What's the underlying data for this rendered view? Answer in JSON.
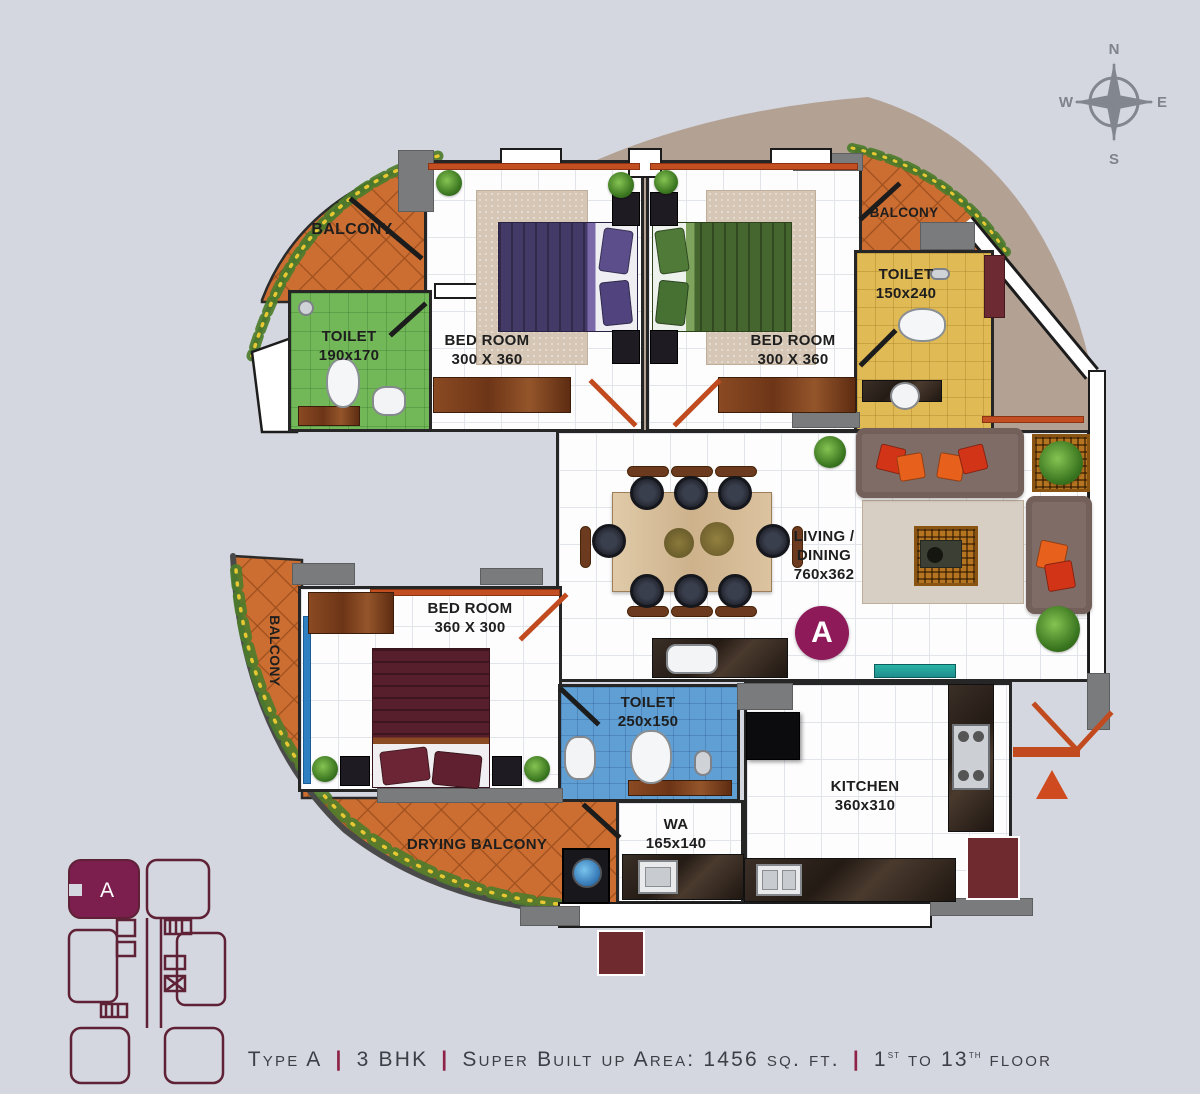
{
  "compass": {
    "north": "N",
    "south": "S",
    "east": "E",
    "west": "W"
  },
  "unit_badge": {
    "label": "A"
  },
  "key_plan": {
    "highlight_label": "A"
  },
  "rooms": {
    "balcony_top_left": {
      "label": "BALCONY"
    },
    "toilet_top_left": {
      "label": "TOILET",
      "size": "190x170"
    },
    "bedroom_top_left": {
      "label": "BED ROOM",
      "size": "300 X 360"
    },
    "bedroom_top_right": {
      "label": "BED ROOM",
      "size": "300 X 360"
    },
    "balcony_top_right": {
      "label": "BALCONY"
    },
    "toilet_top_right": {
      "label": "TOILET",
      "size": "150x240"
    },
    "living_dining": {
      "label_line1": "LIVING /",
      "label_line2": "DINING",
      "size": "760x362"
    },
    "bedroom_left": {
      "label": "BED ROOM",
      "size": "360 X 300"
    },
    "balcony_left": {
      "label": "BALCONY"
    },
    "toilet_center": {
      "label": "TOILET",
      "size": "250x150"
    },
    "wa": {
      "label": "WA",
      "size": "165x140"
    },
    "kitchen": {
      "label": "KITCHEN",
      "size": "360x310"
    },
    "drying_balcony": {
      "label": "DRYING BALCONY"
    }
  },
  "caption": {
    "type": "Type A",
    "bhk": "3 BHK",
    "area": "Super Built up Area: 1456 sq. ft.",
    "floor_pre": "1",
    "floor_sup1": "st",
    "floor_mid": " to 13",
    "floor_sup2": "th",
    "floor_post": " floor",
    "separator": "|"
  },
  "colors": {
    "background": "#d4d7e0",
    "accent_magenta": "#8e1a5a",
    "door_orange": "#c14b1e",
    "balcony_tile_orange": "#cc6e31",
    "toilet_green": "#72b858",
    "toilet_yellow": "#e0ba54",
    "toilet_blue": "#5f9fd3",
    "dome_beige": "#b3a294",
    "keyplan_maroon": "#5e2135"
  }
}
